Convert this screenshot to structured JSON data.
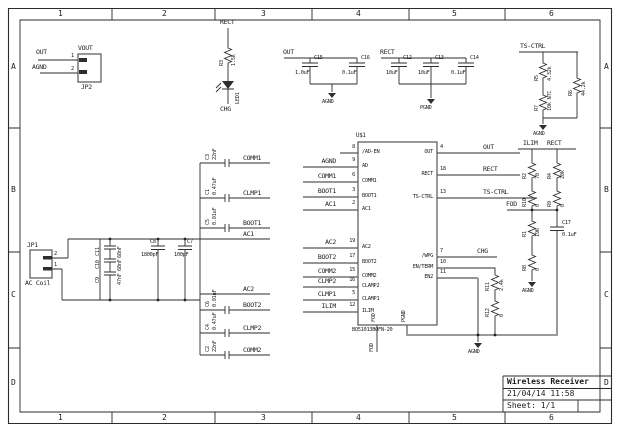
{
  "frame": {
    "cols": [
      "1",
      "2",
      "3",
      "4",
      "5",
      "6"
    ],
    "rows": [
      "A",
      "B",
      "C",
      "D"
    ]
  },
  "title_block": {
    "title": "Wireless Receiver",
    "date": "21/04/14 11:58",
    "sheet": "Sheet: 1/1"
  },
  "jp2": {
    "ref": "JP2",
    "vout": "VOUT",
    "net_out": "OUT",
    "net_gnd": "AGND",
    "pin1": "1",
    "pin2": "2"
  },
  "led": {
    "net_top": "RECT",
    "r_ref": "R3",
    "r_val": "1.5k",
    "ref": "LED1",
    "net_bot": "CHG"
  },
  "grp_out": {
    "net": "OUT",
    "c15": "C15",
    "c15v": "1.0uF",
    "c16": "C16",
    "c16v": "0.1uF",
    "gnd": "AGND"
  },
  "grp_rect": {
    "net": "RECT",
    "c12": "C12",
    "c12v": "10uF",
    "c13": "C13",
    "c13v": "10uF",
    "c14": "C14",
    "c14v": "0.1uF",
    "gnd": "PGND"
  },
  "ts": {
    "net": "TS-CTRL",
    "r5": "R5",
    "r5v": "4.32k",
    "r7": "R7",
    "r7v": "10k NTC",
    "r6": "R6",
    "r6v": "44.2k",
    "gnd": "AGND"
  },
  "fod": {
    "net": "FOD"
  },
  "ilim": {
    "net": "ILIM",
    "r2": "R2",
    "r2v": "70",
    "r10": "R10",
    "r10v": "0",
    "r1": "R1",
    "r1v": "196",
    "r8": "R8",
    "r8v": "0",
    "gnd": "AGND"
  },
  "rectbr": {
    "net": "RECT",
    "r4": "R4",
    "r4v": "20k",
    "r9": "R9",
    "r9v": "0",
    "c17": "C17",
    "c17v": "0.1uF"
  },
  "en": {
    "r11": "R11",
    "r11v": "2.4k",
    "r12": "R12",
    "r12v": "0",
    "gnd": "AGND"
  },
  "ic": {
    "ref": "U$1",
    "part": "BQ51013BQFN-20",
    "left": [
      [
        "8",
        "/AD-EN",
        ""
      ],
      [
        "9",
        "AD",
        "AGND"
      ],
      [
        "6",
        "COMM1",
        "COMM1"
      ],
      [
        "3",
        "BOOT1",
        "BOOT1"
      ],
      [
        "2",
        "AC1",
        "AC1"
      ],
      [
        "19",
        "AC2",
        "AC2"
      ],
      [
        "17",
        "BOOT2",
        "BOOT2"
      ],
      [
        "15",
        "COMM2",
        "COMM2"
      ],
      [
        "16",
        "CLAMP2",
        "CLMP2"
      ],
      [
        "5",
        "CLAMP1",
        "CLMP1"
      ],
      [
        "12",
        "ILIM",
        "ILIM"
      ]
    ],
    "right": [
      [
        "4",
        "OUT",
        "OUT"
      ],
      [
        "18",
        "RECT",
        "RECT"
      ],
      [
        "13",
        "TS-CTRL",
        "TS-CTRL"
      ],
      [
        "7",
        "/WPG",
        "CHG"
      ],
      [
        "10",
        "EN/TERM",
        ""
      ],
      [
        "11",
        "EN2",
        ""
      ]
    ],
    "bottom": [
      "FOD",
      "PGND"
    ],
    "fod_net": "FOD"
  },
  "jp1": {
    "ref": "JP1",
    "label": "AC Coil",
    "pin1": "1",
    "pin2": "2"
  },
  "trio": {
    "c11": "C11",
    "c11v": "68nF",
    "c10": "C10",
    "c10v": "68nF",
    "c9": "C9",
    "c9v": "47nF"
  },
  "series": {
    "c8": "C8",
    "c8v": "1800pF",
    "c7": "C7",
    "c7v": "100pF"
  },
  "bank": {
    "c3": "C3",
    "c3v": "22nF",
    "c1": "C1",
    "c1v": "0.47uF",
    "c5": "C5",
    "c5v": "0.01uF",
    "c6": "C6",
    "c6v": "0.01uF",
    "c4": "C4",
    "c4v": "0.47uF",
    "c2": "C2",
    "c2v": "22nF",
    "n1": "COMM1",
    "n2": "CLMP1",
    "n3": "BOOT1",
    "n4": "AC1",
    "n5": "AC2",
    "n6": "BOOT2",
    "n7": "CLMP2",
    "n8": "COMM2"
  }
}
